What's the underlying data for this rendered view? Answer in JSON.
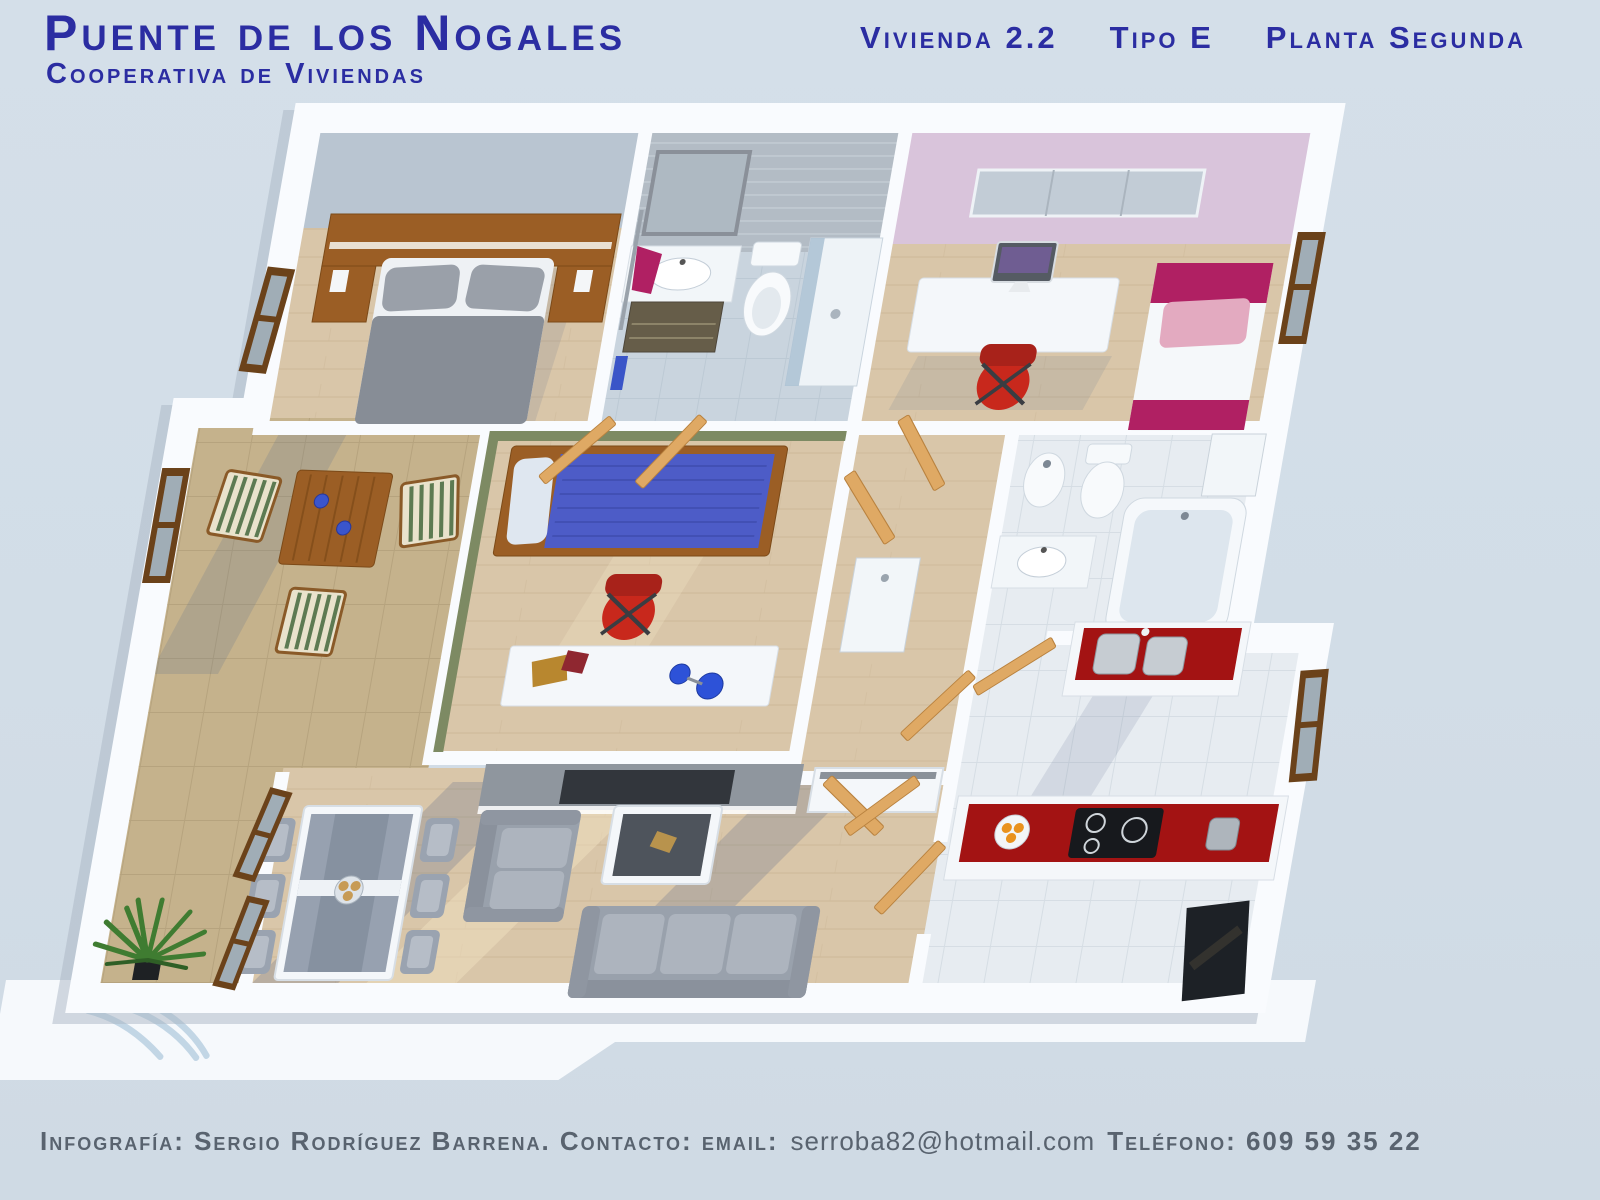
{
  "header": {
    "title": "Puente de los Nogales",
    "subtitle": "Cooperativa de Viviendas",
    "unit": "Vivienda 2.2",
    "type_label": "Tipo E",
    "floor_label": "Planta Segunda"
  },
  "footer": {
    "credit": "Infografía: Sergio Rodríguez Barrena. Contacto: email:",
    "email": "serroba82@hotmail.com",
    "phone": "Teléfono: 609 59 35 22"
  },
  "colors": {
    "background": "#d2dde7",
    "title_blue": "#2b2da2",
    "footer_gray": "#59636f",
    "wood_floor": "#d9c6a9",
    "terrace_tile": "#c5b28c",
    "bath_tile": "#c9d4de",
    "kitchen_tile": "#e7ecf1",
    "wall_shade": "#b9c5d1",
    "tile_wall_gray": "#b3bcc5",
    "pink_wall": "#d9c4db",
    "green_wall": "#7d8a63",
    "dark_wood": "#9b5e25",
    "door_wood": "#dfa964",
    "window_wood": "#6b421a",
    "gray_duvet": "#878d96",
    "blue_duvet": "#4d5cc7",
    "red_accent": "#c8281c",
    "counter_red": "#a31313",
    "magenta": "#b02063",
    "pink_pillow": "#e3aac0",
    "sofa_gray": "#99a1ac",
    "unit_gray": "#8f969e",
    "tv_dark": "#32363c",
    "steel": "#c6ccd2",
    "orange": "#e9921e",
    "plant_green": "#3f7c31"
  }
}
